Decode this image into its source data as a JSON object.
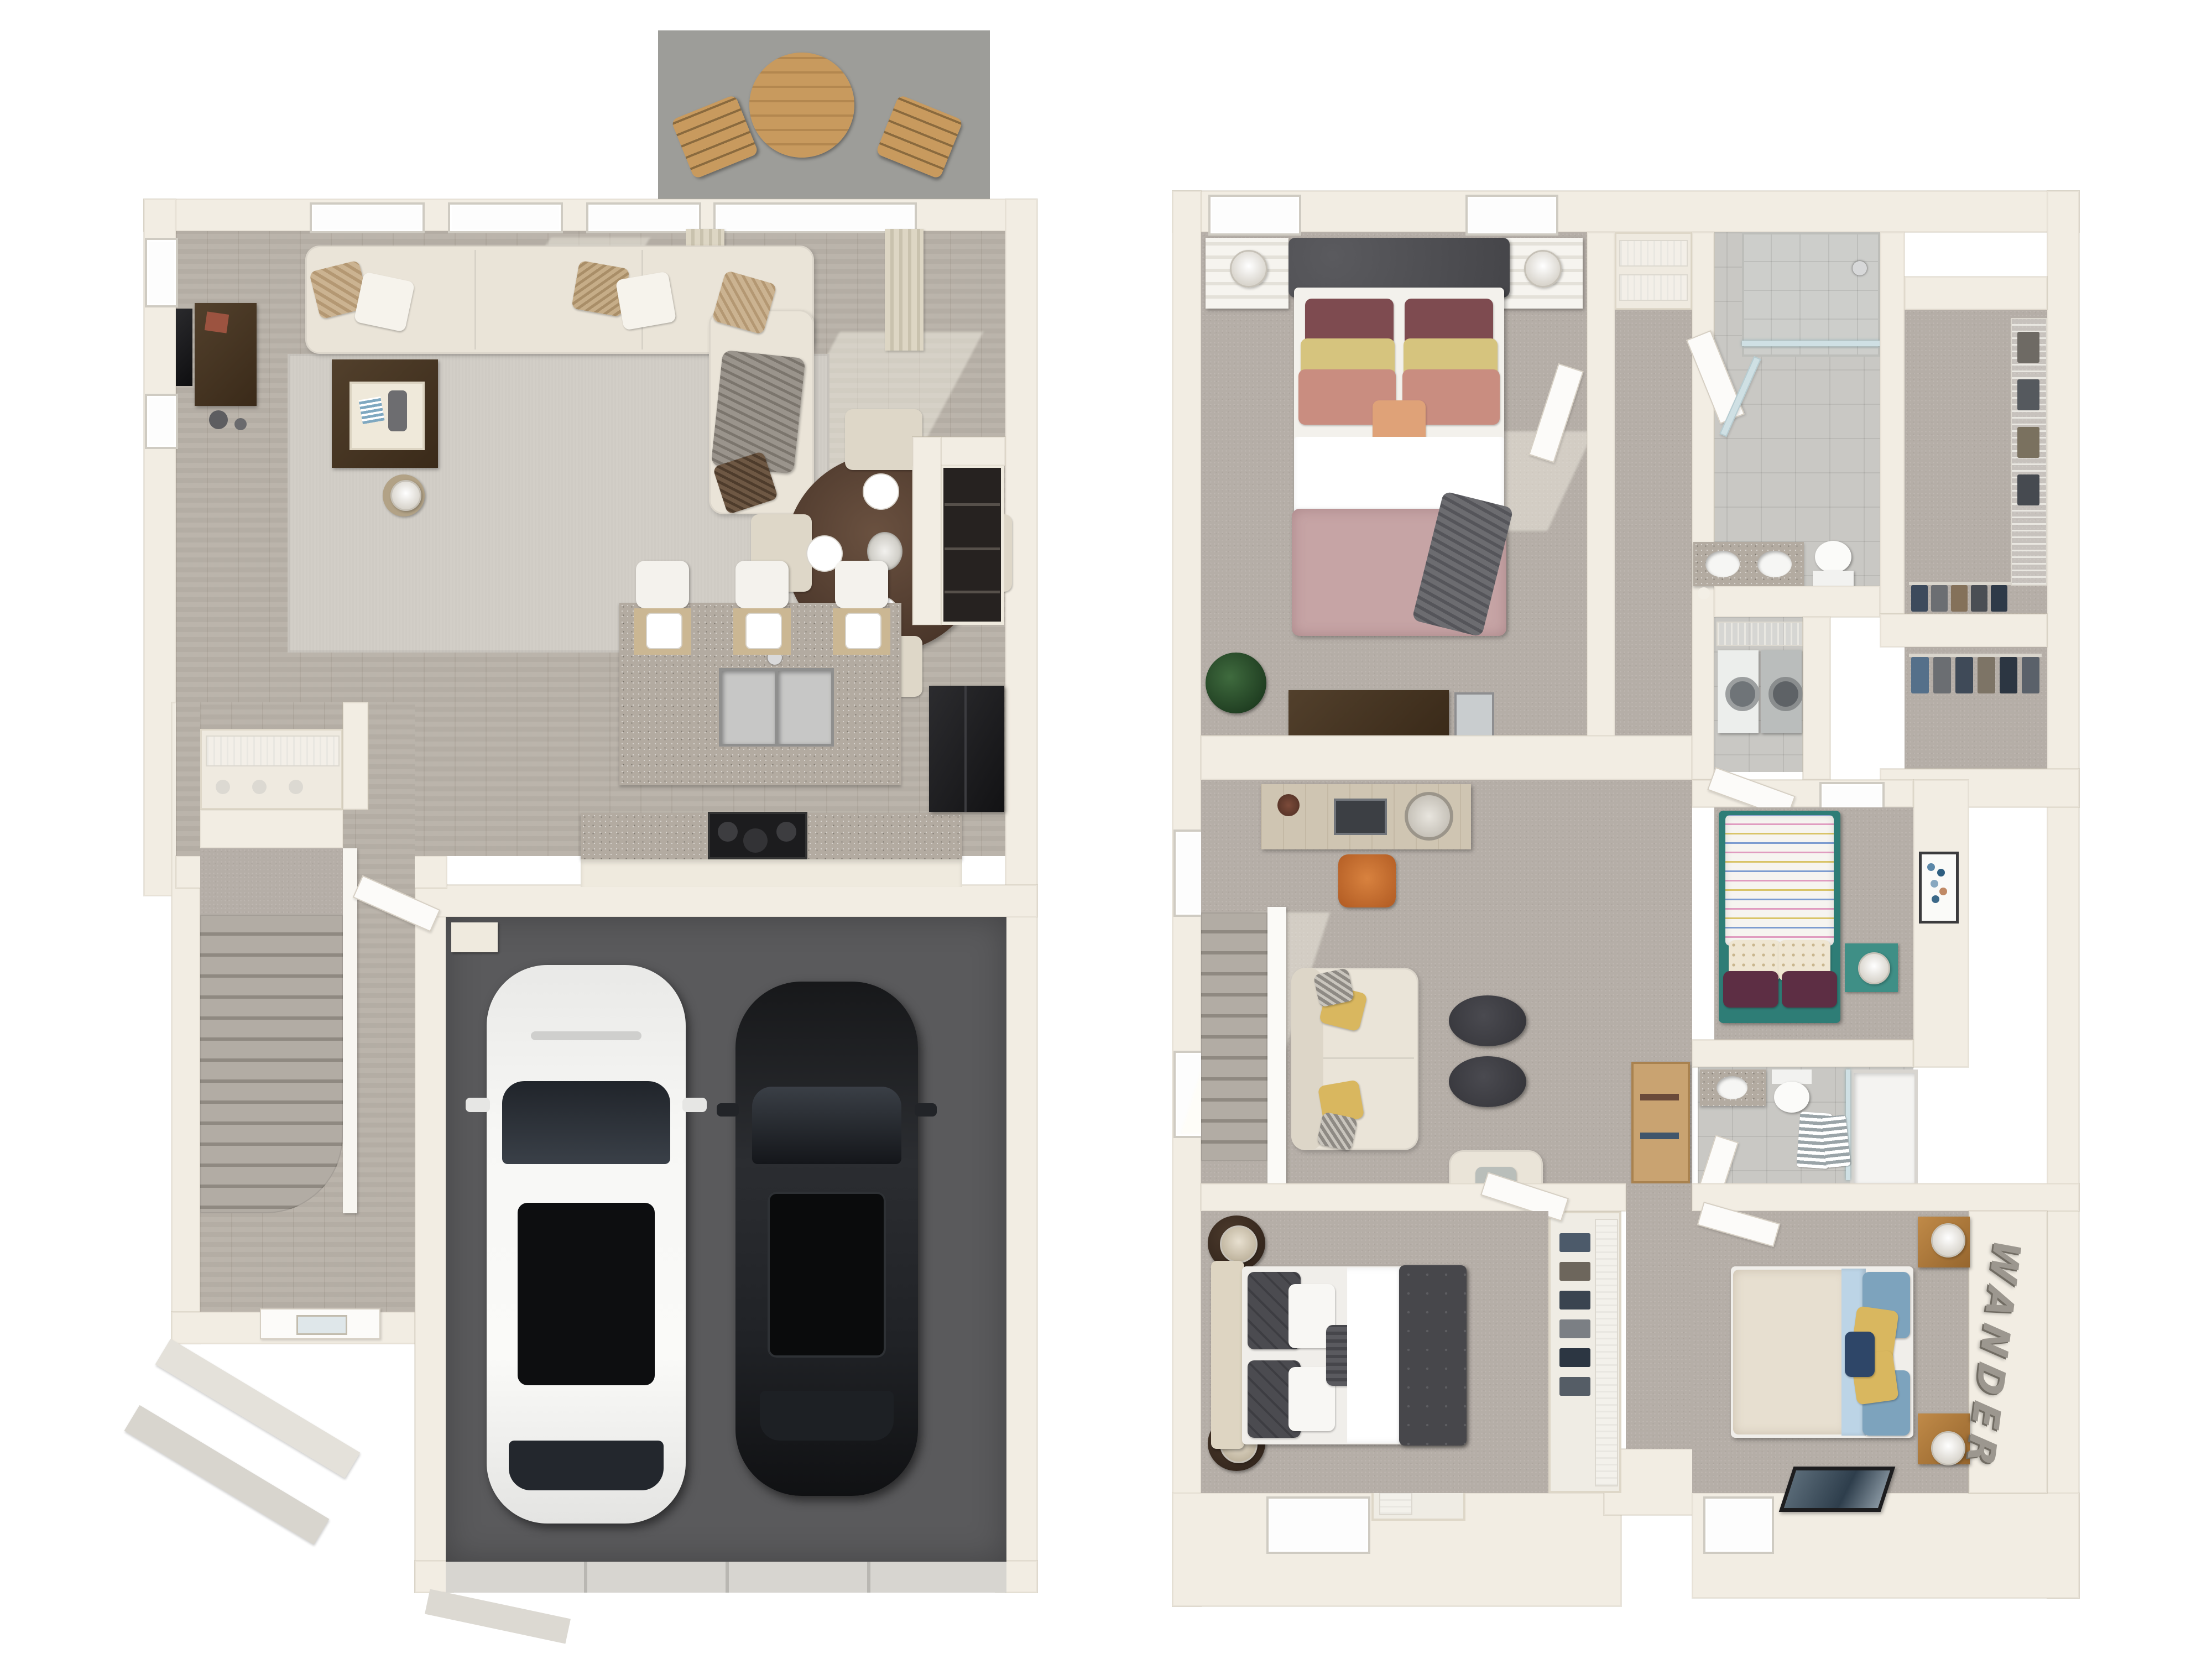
{
  "watermark": {
    "text": "WANDER"
  },
  "palette": {
    "background": "#ffffff",
    "wall": "#f2ede3",
    "wall_deep": "#e3dbca",
    "wood": "#b7b0a7",
    "carpet": "#b5aea7",
    "tile": "#c9c8c4",
    "granite": "#b3aba1",
    "garage": "#5a5a5c",
    "patio": "#9d9d99",
    "rug": "#cfcbc4",
    "sofa": "#eae4d8",
    "darkwood": "#43311f",
    "teal": "#2e7d76",
    "mauve": "#c6a4a5",
    "orange": "#c96a2e",
    "glass": "#cfe0e4",
    "black": "#1b1b1d",
    "duvet_dark": "#47474b",
    "pillow_blue": "#7da3bd",
    "pillow_yellow": "#d9b75f",
    "navy": "#2e4668",
    "letters": "#9c978f",
    "lightwood": "#cdbfa5",
    "oak": "#b5793c"
  }
}
